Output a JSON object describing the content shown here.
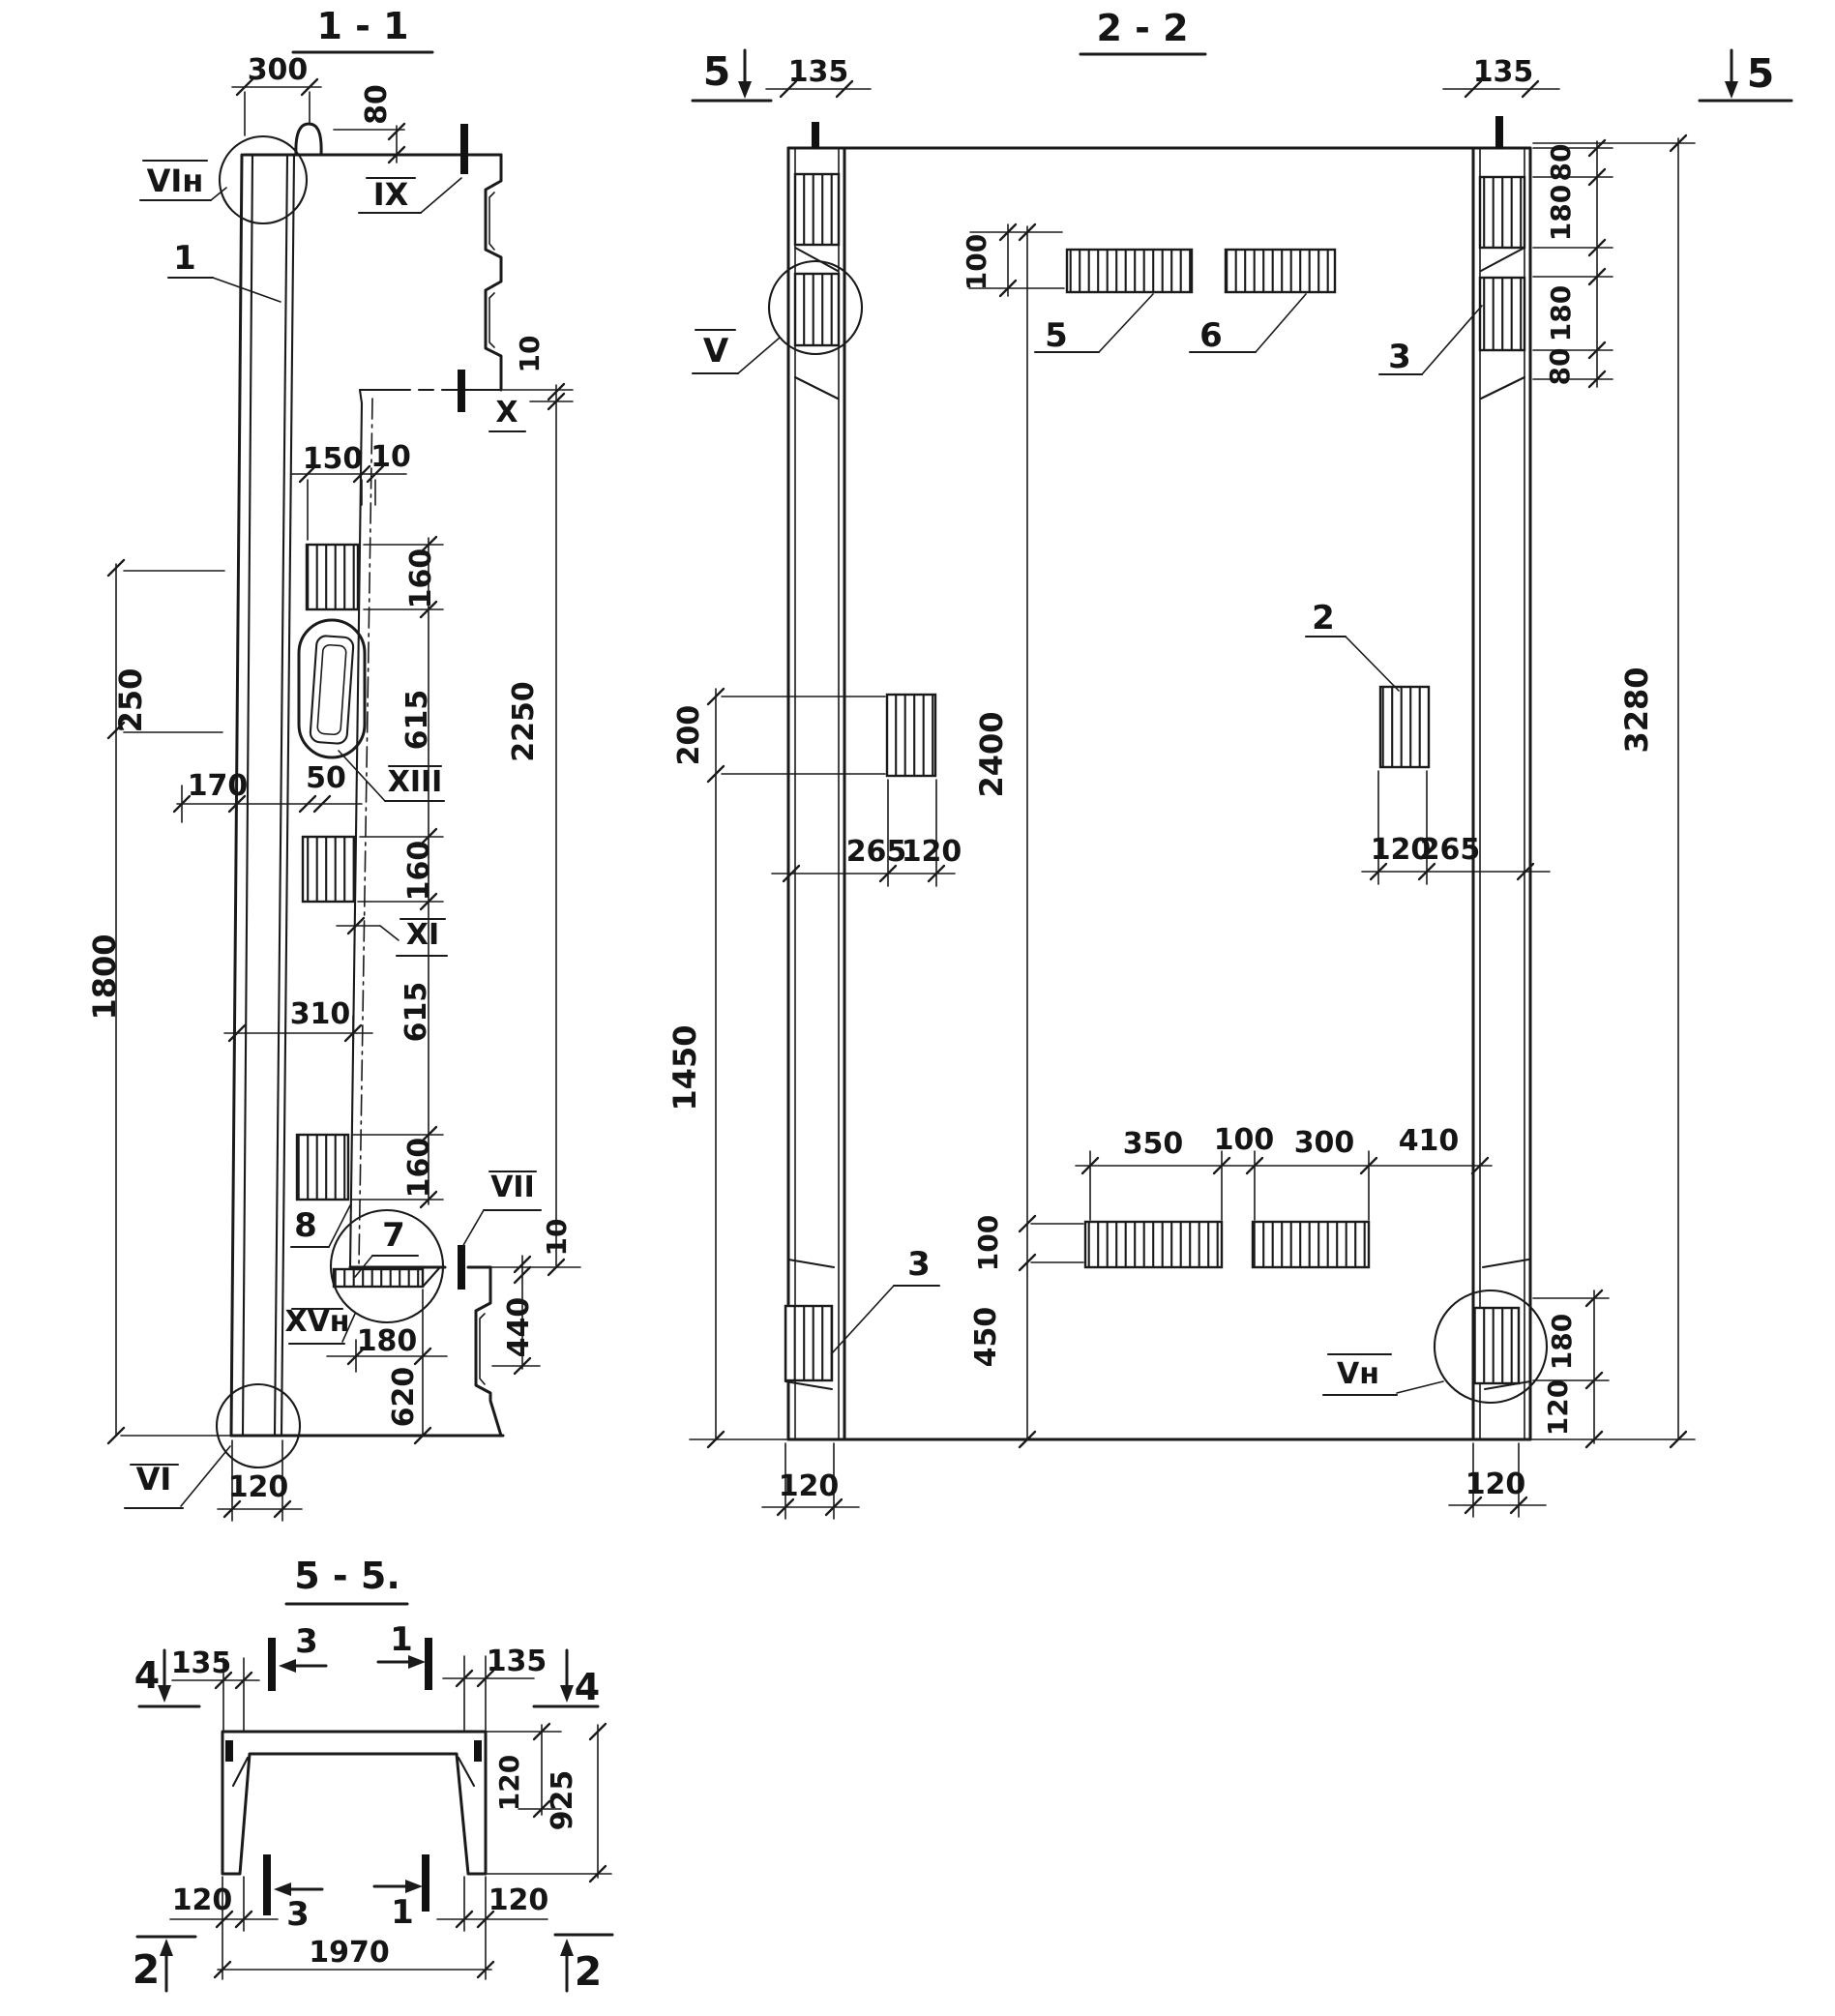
{
  "s11": {
    "title": "1 - 1",
    "labels": {
      "p1": "1",
      "p7": "7",
      "p8": "8"
    },
    "markers": {
      "vi_n": "VIн",
      "ix": "IX",
      "x": "X",
      "xiii": "XIII",
      "xi": "XI",
      "vii": "VII",
      "xv_n": "XVн",
      "vi": "VI"
    },
    "dims": {
      "d300": "300",
      "d80": "80",
      "d10_step": "10",
      "d150": "150",
      "d10_w": "10",
      "d250": "250",
      "d160a": "160",
      "d615a": "615",
      "d170": "170",
      "d50": "50",
      "d2250": "2250",
      "d160b": "160",
      "d615b": "615",
      "d310": "310",
      "d160c": "160",
      "d1800": "1800",
      "d10_b": "10",
      "d440": "440",
      "d180": "180",
      "d620": "620",
      "d120": "120"
    }
  },
  "s22": {
    "title": "2 - 2",
    "cuts": {
      "c5l": "5",
      "c5r": "5"
    },
    "labels": {
      "p5": "5",
      "p6": "6",
      "p3a": "3",
      "p2": "2",
      "p3b": "3"
    },
    "markers": {
      "v": "V",
      "v_n": "Vн"
    },
    "dims": {
      "d135l": "135",
      "d135r": "135",
      "d80a": "80",
      "d180a": "180",
      "d180b": "180",
      "d80b": "80",
      "d3280": "3280",
      "d100t": "100",
      "d200": "200",
      "d2400": "2400",
      "d265l": "265",
      "d120l": "120",
      "d120r": "120",
      "d265r": "265",
      "d1450": "1450",
      "d350": "350",
      "d100m": "100",
      "d300": "300",
      "d410": "410",
      "d100b": "100",
      "d450": "450",
      "d180c": "180",
      "d120c": "120",
      "d120bl": "120",
      "d120br": "120"
    }
  },
  "s55": {
    "title": "5 - 5.",
    "cuts": {
      "c3t": "3",
      "c1t": "1",
      "c4l": "4",
      "c4r": "4",
      "c3b": "3",
      "c1b": "1",
      "c2l": "2",
      "c2r": "2"
    },
    "dims": {
      "d135l": "135",
      "d135r": "135",
      "d120t": "120",
      "d925": "925",
      "d120bl": "120",
      "d120br": "120",
      "d1970": "1970"
    }
  }
}
